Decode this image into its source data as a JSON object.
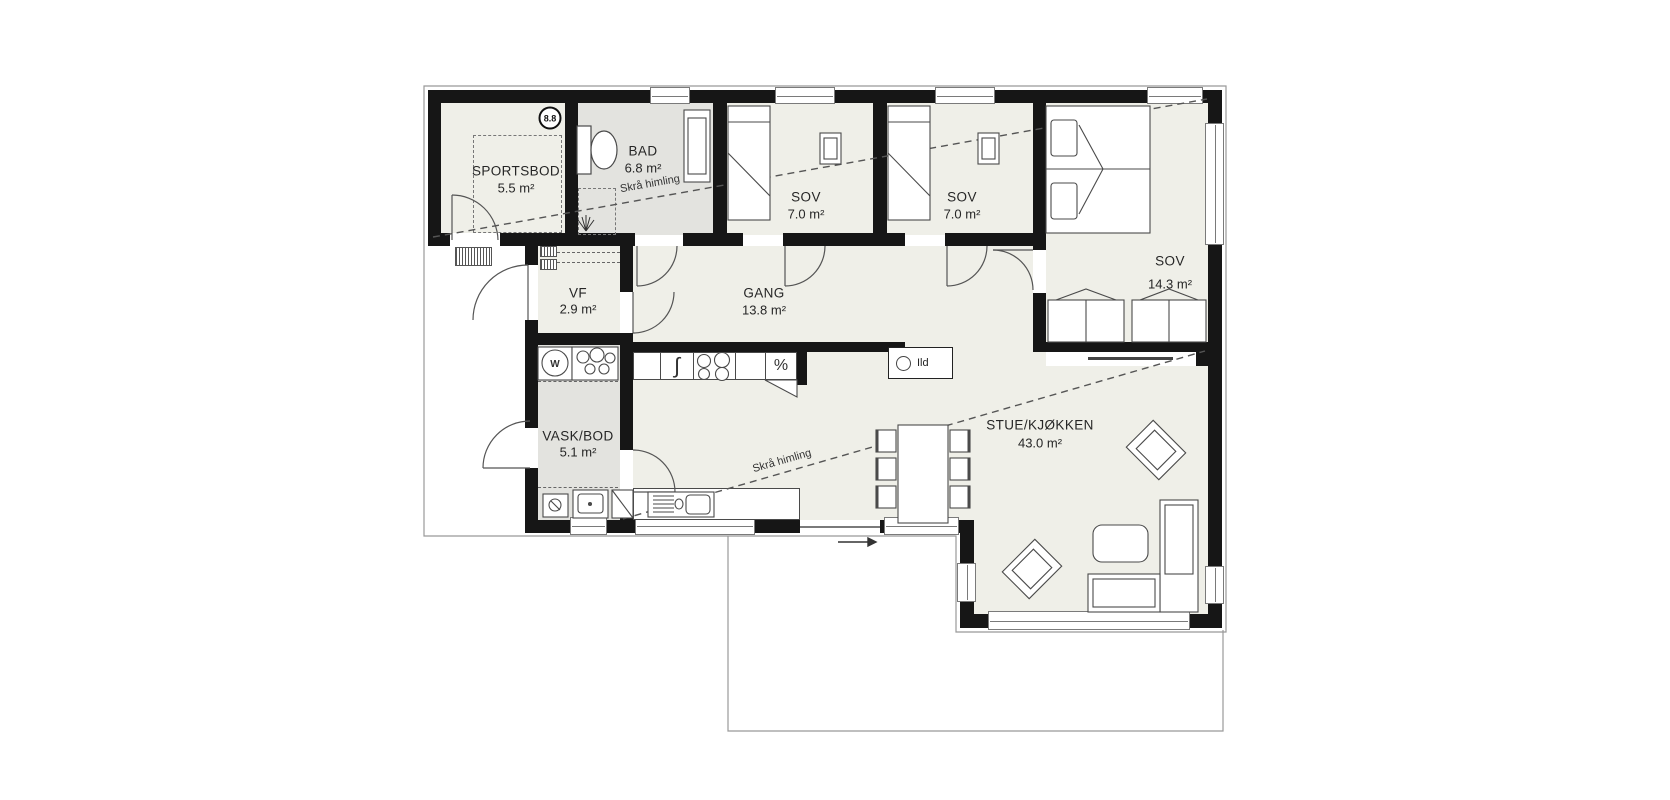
{
  "plan": {
    "rooms": [
      {
        "name": "SPORTSBOD",
        "area": "5.5 m²"
      },
      {
        "name": "BAD",
        "area": "6.8 m²"
      },
      {
        "name": "SOV",
        "area": "7.0 m²"
      },
      {
        "name": "SOV",
        "area": "7.0 m²"
      },
      {
        "name": "SOV",
        "area": "14.3 m²"
      },
      {
        "name": "VF",
        "area": "2.9 m²"
      },
      {
        "name": "GANG",
        "area": "13.8 m²"
      },
      {
        "name": "VASK/BOD",
        "area": "5.1 m²"
      },
      {
        "name": "STUE/KJØKKEN",
        "area": "43.0 m²"
      }
    ],
    "annotations": {
      "sloped_ceiling_1": "Skrå himling",
      "sloped_ceiling_2": "Skrå himling",
      "fireplace": "Ild",
      "ridge_badge": "8.8",
      "washer": "W",
      "dishwasher_symbol": "∫",
      "fridge_symbol": "%"
    },
    "colors": {
      "wall": "#161616",
      "floor": "#EFEFE8",
      "wet_floor": "#E3E3DF",
      "outline": "#999999"
    }
  }
}
